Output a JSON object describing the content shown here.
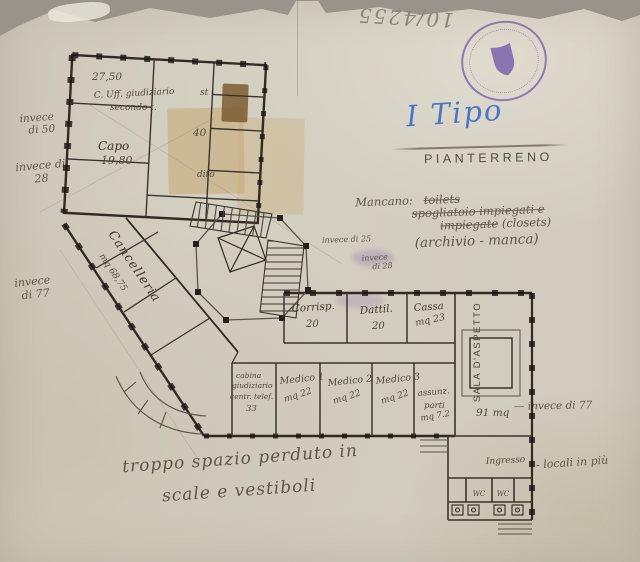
{
  "meta": {
    "archive_number": "10/4255"
  },
  "stamp": {
    "description": "round purple archive stamp with shield",
    "color": "#7059a9"
  },
  "header": {
    "type_label": "I Tipo",
    "floor_label": "PIANTERRENO"
  },
  "notes": {
    "mancano_heading": "Mancano:",
    "mancano_struck_1": "toilets",
    "mancano_struck_2": "spogliatoio impiegati e",
    "mancano_struck_3": "impiegate",
    "mancano_kept_3": " (closets)",
    "mancano_final": "(archivio - manca)",
    "left_1a": "invece",
    "left_1b": "di 50",
    "left_2a": "invece di",
    "left_2b": "28",
    "left_3a": "invece",
    "left_3b": "di 77",
    "mid_1": "invece di 25",
    "mid_2a": "invece",
    "mid_2b": "di 28",
    "right_invece": "— invece di 77",
    "right_locali": "- locali in più",
    "bottom_1": "troppo spazio perduto in",
    "bottom_2": "scale e vestiboli"
  },
  "plan": {
    "elevation": "27,50",
    "rooms": {
      "uff_l1": "C. Uff. giudiziario",
      "uff_l2": "secondo t.",
      "capo": "Capo",
      "capo_area": "19,80",
      "st": "st",
      "n40": "40",
      "dito": "dito",
      "cancelleria": "Cancelleria",
      "cancelleria_area": "mq 68,75",
      "corrisp": "Corrisp.",
      "corrisp_area": "20",
      "dattil": "Dattil.",
      "dattil_area": "20",
      "cassa": "Cassa",
      "cassa_area": "mq 23",
      "medico1": "Medico 1",
      "medico1_area": "mq 22",
      "medico2": "Medico 2",
      "medico2_area": "mq 22",
      "medico3": "Medico 3",
      "medico3_area": "mq 22",
      "cabina_l1": "cabina",
      "cabina_l2": "giudiziario",
      "cabina_l3": "centr. telef.",
      "cabina_l4": "33",
      "assunz_l1": "assunz.",
      "assunz_l2": "parti",
      "assunz_l3": "mq 7.2",
      "sala": "SALA D'ASPETTO",
      "sala_area": "91 mq",
      "ingresso": "Ingresso",
      "wc1": "WC",
      "wc2": "WC"
    }
  }
}
